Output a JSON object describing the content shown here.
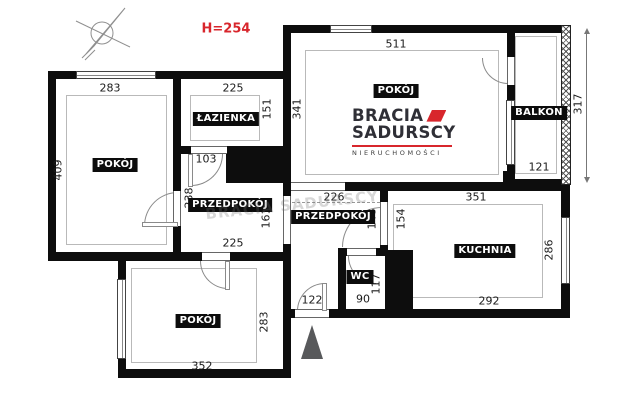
{
  "annotations": {
    "ceiling_height": "H=254",
    "watermark": "BRACIA SADURSCY"
  },
  "logo": {
    "line1": "BRACIA",
    "line2": "SADURSCY",
    "tagline": "NIERUCHOMOŚCI"
  },
  "colors": {
    "accent_red": "#d8262c",
    "wall_black": "#0d0d0d",
    "entrance_arrow_gray": "#58595b"
  },
  "icons": {
    "compass": "north-arrow-icon",
    "entrance": "entrance-arrow-icon"
  },
  "rooms": [
    {
      "name": "pokoj-main",
      "label": "POKÓJ"
    },
    {
      "name": "pokoj-left",
      "label": "POKÓJ"
    },
    {
      "name": "pokoj-bottom",
      "label": "POKÓJ"
    },
    {
      "name": "lazienka",
      "label": "ŁAZIENKA"
    },
    {
      "name": "przedpokoj-west",
      "label": "PRZEDPOKÓJ"
    },
    {
      "name": "przedpokoj-east",
      "label": "PRZEDPOKÓJ"
    },
    {
      "name": "kuchnia",
      "label": "KUCHNIA"
    },
    {
      "name": "balkon",
      "label": "BALKON"
    },
    {
      "name": "wc",
      "label": "WC"
    }
  ],
  "dimensions": {
    "pokoj_main_width": "511",
    "pokoj_main_depth": "341",
    "pokoj_left_width": "283",
    "pokoj_left_depth": "409",
    "lazienka_width": "225",
    "lazienka_depth": "151",
    "lazienka_door": "103",
    "przedpokoj_west_depth": "238",
    "przedpokoj_west_inner": "161",
    "przedpokoj_west_width": "225",
    "przedpokoj_east_width": "226",
    "przedpokoj_east_depth": "148",
    "kuchnia_entry": "154",
    "kuchnia_width": "351",
    "kuchnia_depth": "286",
    "kuchnia_bottom": "292",
    "balkon_width": "121",
    "balkon_depth": "317",
    "wc_width": "90",
    "wc_depth": "117",
    "entrance_door": "122",
    "pokoj_bottom_depth": "283",
    "pokoj_bottom_width": "352"
  }
}
